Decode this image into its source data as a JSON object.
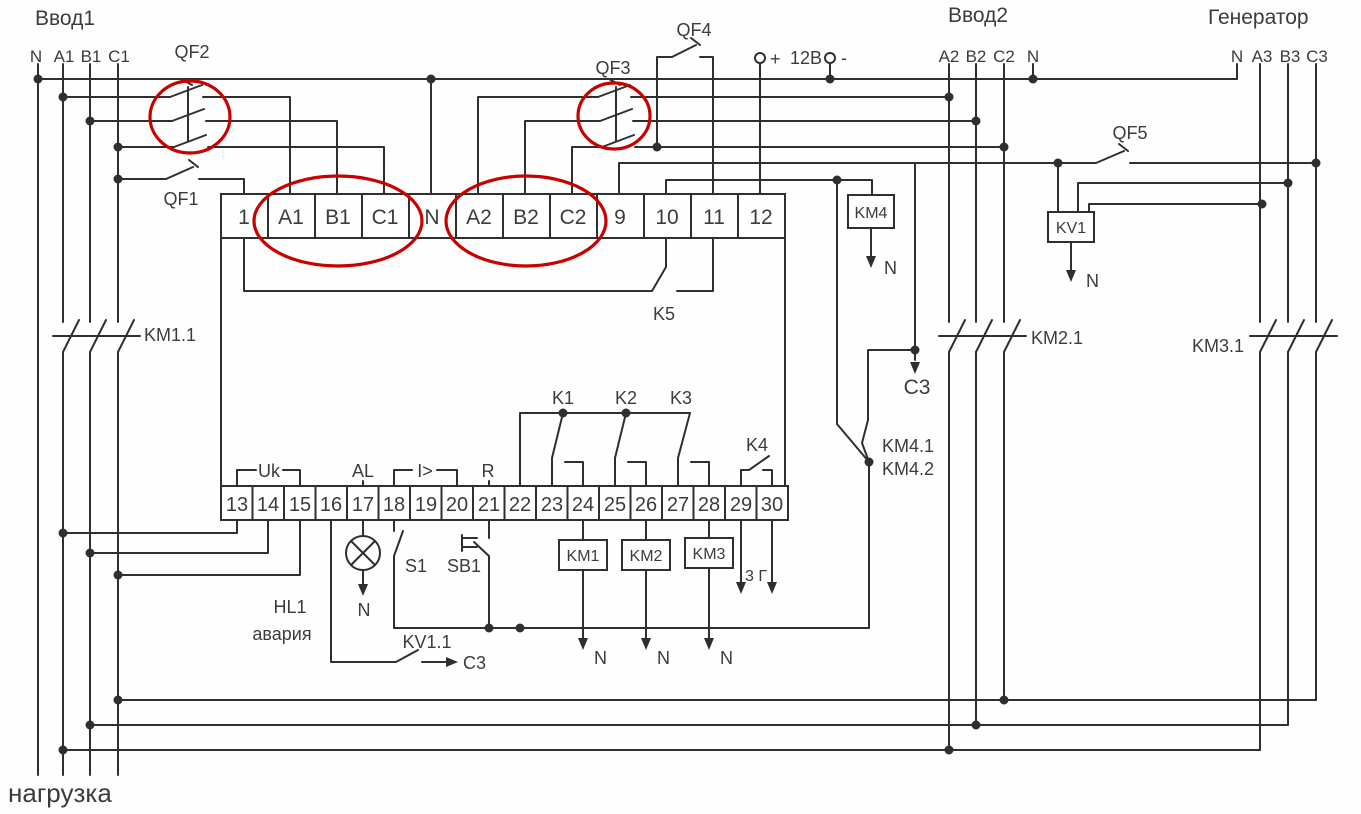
{
  "colors": {
    "background": "#fefefe",
    "line": "#2f2f2f",
    "text": "#3c3c3c",
    "highlight_red": "#c80000"
  },
  "headers": {
    "input1": "Ввод1",
    "input2": "Ввод2",
    "generator": "Генератор",
    "load": "нагрузка"
  },
  "feeders": {
    "input1_lines": [
      "N",
      "A1",
      "B1",
      "C1"
    ],
    "input2_lines": [
      "A2",
      "B2",
      "C2",
      "N"
    ],
    "generator_lines": [
      "N",
      "A3",
      "B3",
      "C3"
    ]
  },
  "breakers": {
    "qf1": "QF1",
    "qf2": "QF2",
    "qf3": "QF3",
    "qf4": "QF4",
    "qf5": "QF5"
  },
  "power": {
    "plus": "+",
    "supply": "12В",
    "minus": "-"
  },
  "terminals": {
    "top": [
      "1",
      "A1",
      "B1",
      "C1",
      "N",
      "A2",
      "B2",
      "C2",
      "9",
      "10",
      "11",
      "12"
    ],
    "bottom": [
      "13",
      "14",
      "15",
      "16",
      "17",
      "18",
      "19",
      "20",
      "21",
      "22",
      "23",
      "24",
      "25",
      "26",
      "27",
      "28",
      "29",
      "30"
    ]
  },
  "function_labels": {
    "uk": "Uk",
    "al": "AL",
    "overcurrent": "I>",
    "r": "R"
  },
  "relay_contacts": {
    "k1": "K1",
    "k2": "K2",
    "k3": "K3",
    "k4": "K4",
    "k5": "K5",
    "kv1_1": "KV1.1",
    "km4_1": "KM4.1",
    "km4_2": "KM4.2"
  },
  "contactors": {
    "km1": "KM1",
    "km2": "KM2",
    "km3": "KM3",
    "km4": "KM4",
    "kv1": "KV1",
    "km1_1": "KM1.1",
    "km2_1": "KM2.1",
    "km3_1": "KM3.1"
  },
  "annotations": {
    "neutral": "N",
    "c3_ref": "C3",
    "gen_start": "3 Г",
    "lamp": "HL1",
    "alarm": "авария",
    "s1": "S1",
    "sb1": "SB1"
  }
}
